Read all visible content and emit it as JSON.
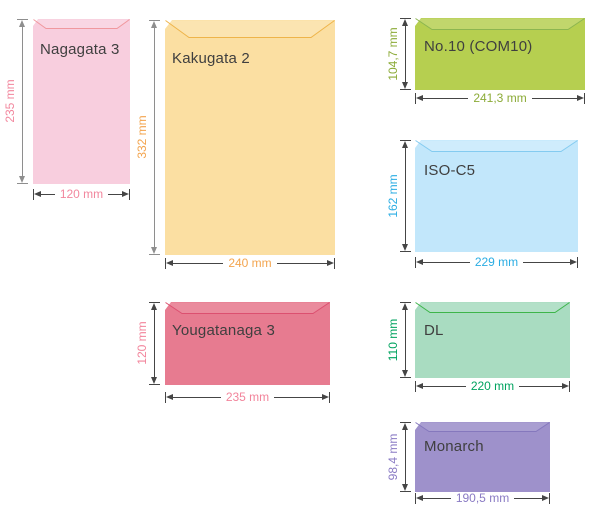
{
  "colors": {
    "background": "#ffffff",
    "name_text": "#3f3f3f",
    "arrow_dark": "#454545",
    "arrow_gray": "#8e8e8e"
  },
  "envelopes": [
    {
      "name": "Nagagata 3",
      "height_label": "235 mm",
      "width_label": "120 mm",
      "fill": "#f8cede",
      "flap_stroke": "#f0989e",
      "accent": "#f2879e",
      "v_arrow": "#8e8e8e"
    },
    {
      "name": "Kakugata 2",
      "height_label": "332 mm",
      "width_label": "240 mm",
      "fill": "#fbdfa2",
      "flap_stroke": "#eeb44a",
      "accent": "#f3a44e",
      "v_arrow": "#8e8e8e"
    },
    {
      "name": "Yougatanaga 3",
      "height_label": "120 mm",
      "width_label": "235 mm",
      "fill": "#e77b90",
      "flap_stroke": "#dc5070",
      "accent": "#f2849b",
      "v_arrow": "#454545"
    },
    {
      "name": "No.10 (COM10)",
      "height_label": "104,7 mm",
      "width_label": "241,3 mm",
      "fill": "#b6cf50",
      "flap_stroke": "#8cb650",
      "accent": "#8cab38",
      "v_arrow": "#454545"
    },
    {
      "name": "ISO-C5",
      "height_label": "162 mm",
      "width_label": "229 mm",
      "fill": "#c2e7fb",
      "flap_stroke": "#84cbf0",
      "accent": "#2bade3",
      "v_arrow": "#454545"
    },
    {
      "name": "DL",
      "height_label": "110 mm",
      "width_label": "220 mm",
      "fill": "#a9dcc1",
      "flap_stroke": "#3db54a",
      "accent": "#00a35f",
      "v_arrow": "#454545"
    },
    {
      "name": "Monarch",
      "height_label": "98,4 mm",
      "width_label": "190,5 mm",
      "fill": "#9e91cb",
      "flap_stroke": "#8578bd",
      "accent": "#8a7bc4",
      "v_arrow": "#454545"
    }
  ]
}
